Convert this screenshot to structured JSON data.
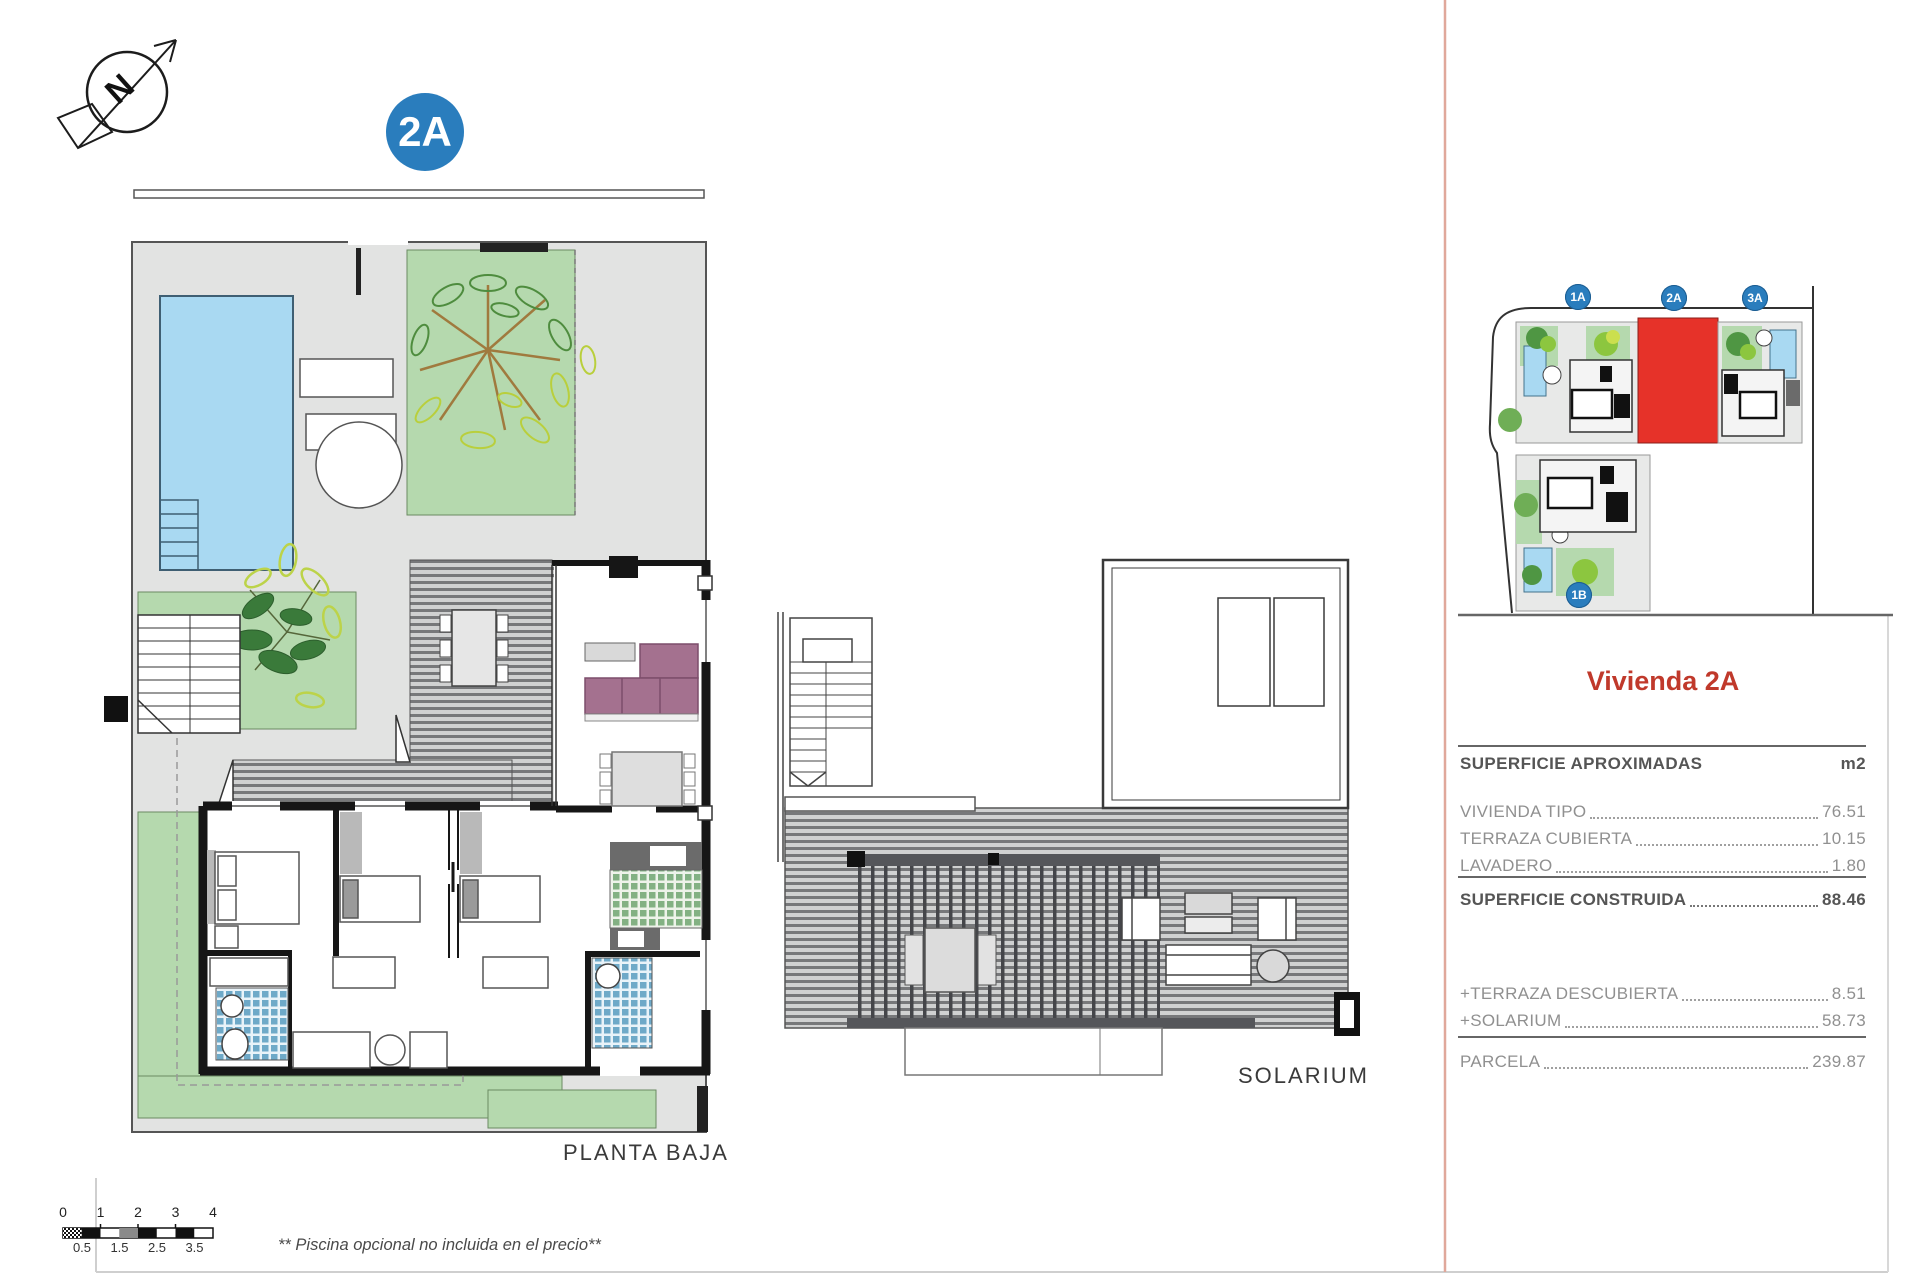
{
  "page": {
    "plan_badge": "2A",
    "north_label": "N",
    "footnote": "** Piscina opcional no incluida en el precio**"
  },
  "plans": {
    "planta_baja_label": "PLANTA BAJA",
    "solarium_label": "SOLARIUM"
  },
  "site_plan": {
    "badges": [
      {
        "label": "1A"
      },
      {
        "label": "2A"
      },
      {
        "label": "3A"
      },
      {
        "label": "1B"
      }
    ],
    "highlighted_plot": "2A",
    "highlight_color": "#e63229",
    "badge_color": "#2a7dbd"
  },
  "panel": {
    "title": "Vivienda 2A",
    "title_color": "#c0392b",
    "header": {
      "label": "SUPERFICIE APROXIMADAS",
      "unit": "m2"
    },
    "rows": [
      {
        "label": "VIVIENDA TIPO",
        "value": "76.51"
      },
      {
        "label": "TERRAZA CUBIERTA",
        "value": "10.15"
      },
      {
        "label": "LAVADERO",
        "value": "1.80"
      }
    ],
    "total": {
      "label": "SUPERFICIE CONSTRUIDA",
      "value": "88.46"
    },
    "extras": [
      {
        "label": "+TERRAZA DESCUBIERTA",
        "value": "8.51"
      },
      {
        "label": "+SOLARIUM",
        "value": "58.73"
      }
    ],
    "parcel": {
      "label": "PARCELA",
      "value": "239.87"
    }
  },
  "scale_bar": {
    "top_labels": [
      "0",
      "1",
      "2",
      "3",
      "4"
    ],
    "bottom_labels": [
      "0.5",
      "1.5",
      "2.5",
      "3.5"
    ]
  }
}
